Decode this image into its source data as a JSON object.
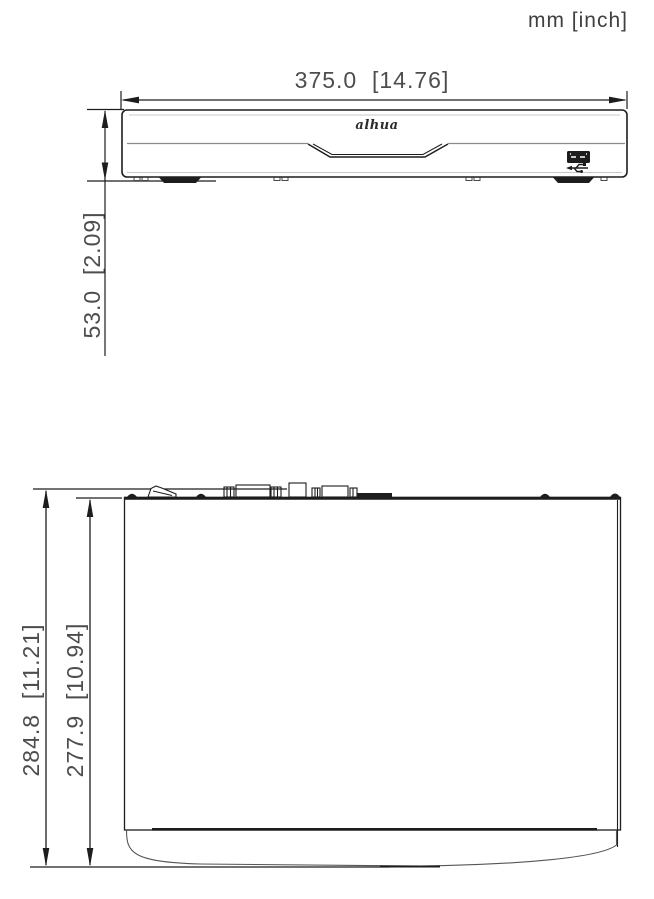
{
  "drawing": {
    "title": "device-dimensions-diagram",
    "units_label": "mm [inch]",
    "brand_logo_text": "alhua",
    "front_view": {
      "width_dim_label": "375.0  [14.76]",
      "height_dim_label": "53.0  [2.09]"
    },
    "top_view": {
      "outer_depth_dim_label": "284.8  [11.21]",
      "inner_depth_dim_label": "277.9  [10.94]"
    },
    "colors": {
      "line": "#1d1d1d",
      "dim_text": "#4d4d4d",
      "light_line": "#c8c8c8",
      "background": "#ffffff"
    }
  }
}
